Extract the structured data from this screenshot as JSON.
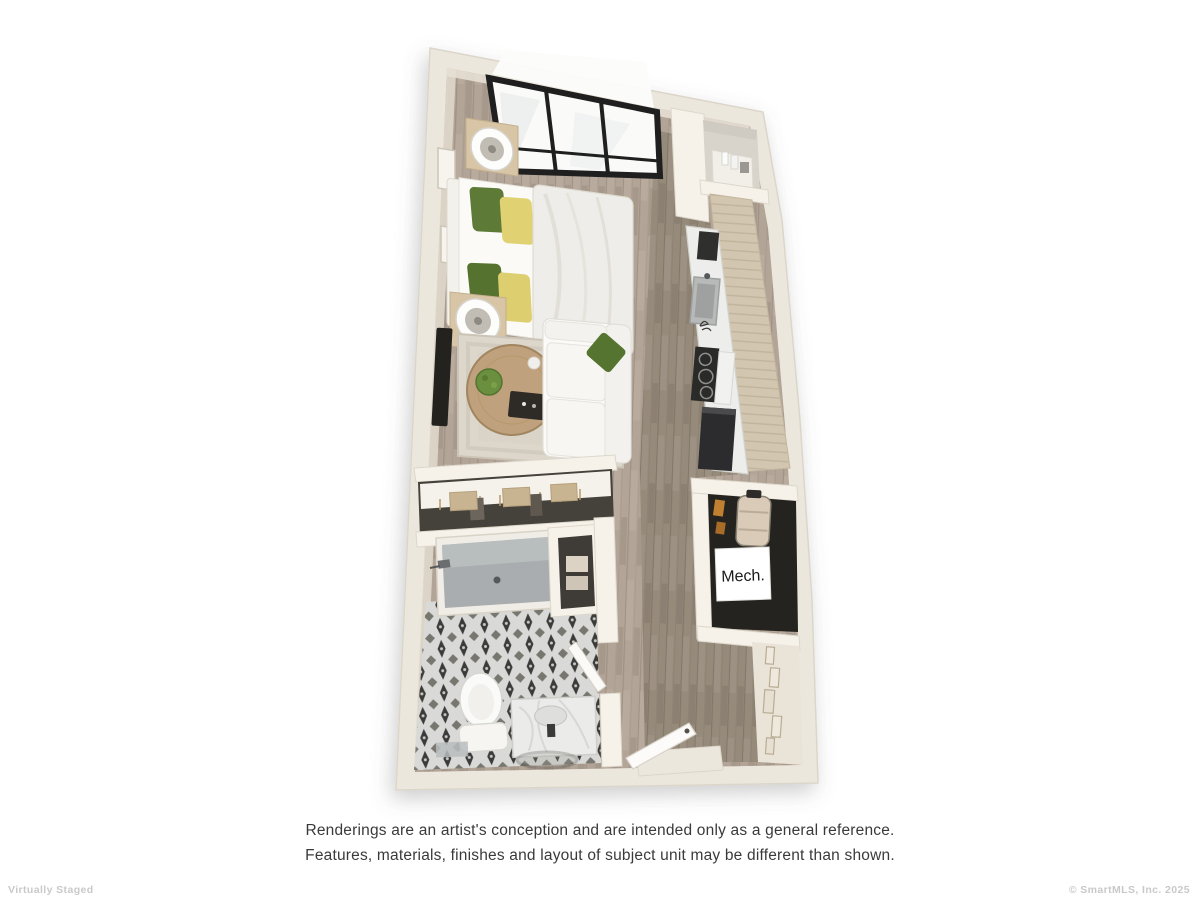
{
  "floorplan": {
    "mech_label": "Mech.",
    "colors": {
      "outer_wall": "#ece7dd",
      "interior_wall": "#f6f2ea",
      "floor_light_wood": "#b2a496",
      "floor_dark_wood": "#968a7b",
      "cabinet_tan": "#d2c6b0",
      "tile_light": "#d9d9d7",
      "tile_dark": "#3b3b39",
      "pillow_green": "#5d7a36",
      "pillow_yellow": "#e0d173",
      "table_wood": "#bfa17d",
      "appliance_dark": "#2c2c2e",
      "mech_floor": "#24231f",
      "window_frame": "#1f1f1f"
    }
  },
  "disclaimer": {
    "line1": "Renderings are an artist's conception and are intended only as a general reference.",
    "line2": "Features, materials, finishes and layout of subject unit may be different than shown."
  },
  "footer": {
    "left": "Virtually Staged",
    "right": "© SmartMLS, Inc.  2025"
  }
}
